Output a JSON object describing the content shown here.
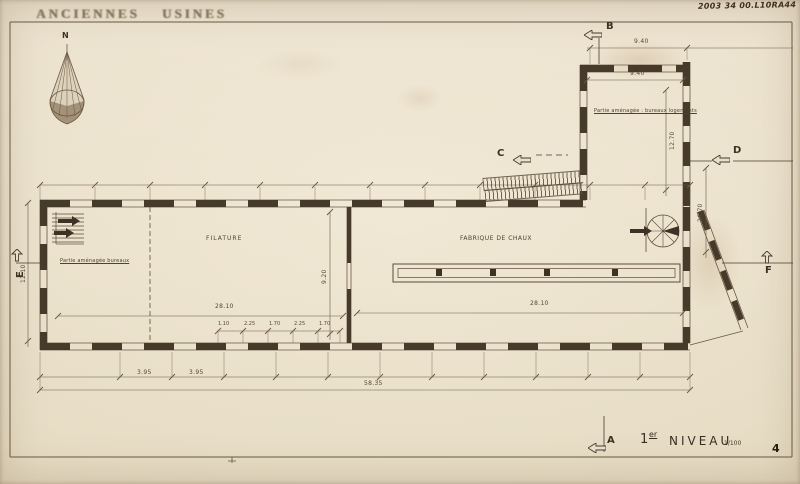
{
  "sheet": {
    "stamp_title": "ANCIENNES USINES",
    "reference_number": "2003 34 00.L10RA44",
    "page_number": "4"
  },
  "titleblock": {
    "level_number": "1",
    "level_suffix": "er",
    "level_word": "NIVEAU",
    "scale": "1/100"
  },
  "compass": {
    "north_label": "N"
  },
  "section_markers": {
    "a": "A",
    "b": "B",
    "c": "C",
    "d": "D",
    "e": "E",
    "f": "F"
  },
  "rooms": {
    "filature": "FILATURE",
    "fabrique": "FABRIQUE  DE  CHAUX",
    "bureaux": "Partie aménagée bureaux",
    "bureaux_logements": "Partie aménagée : bureaux logements"
  },
  "dimensions": {
    "wing_width": "9.40",
    "wing_width_inner": "9.40",
    "wing_height": "12.70",
    "right_height": "26.70",
    "left_height": "12.10",
    "hall_width": "9.20",
    "left_hall_length": "28.10",
    "right_hall_length": "28.10",
    "bays": [
      "1.10",
      "2.25",
      "1.70",
      "2.25",
      "1.70"
    ],
    "bottom_bay_1": "3.95",
    "bottom_bay_2": "3.95",
    "total_length": "58.35"
  }
}
